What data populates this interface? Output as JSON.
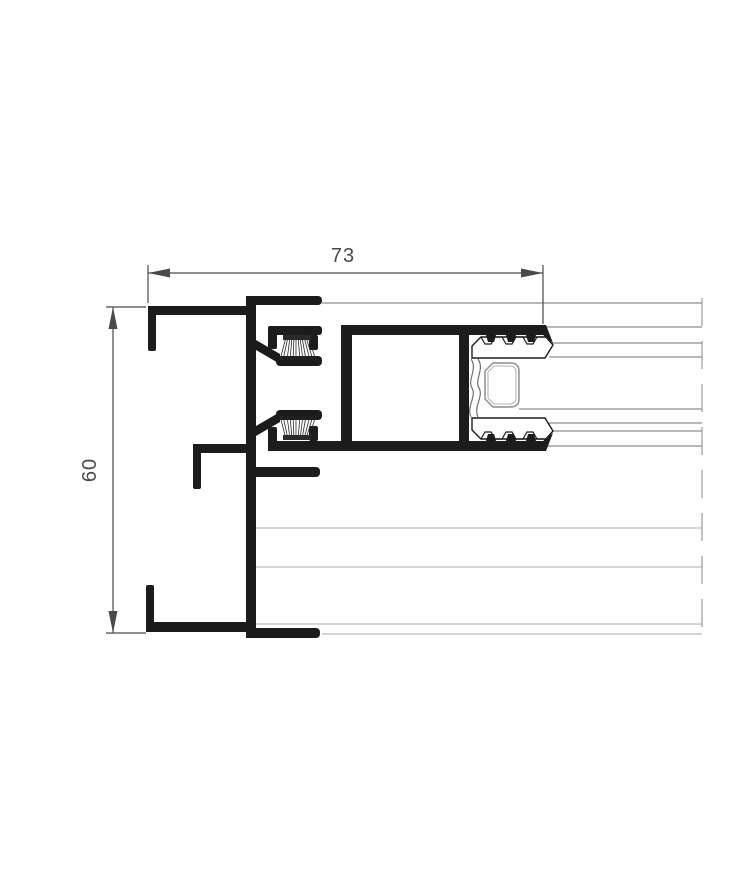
{
  "drawing": {
    "width_dimension_label": "73",
    "height_dimension_label": "60"
  },
  "colors": {
    "profile": "#1c1c1c",
    "bristle": "#2a2a2a",
    "dimension": "#4a4a4a",
    "glass_line": "#6f6f6f",
    "panel_line": "#bcbcbc",
    "break_line": "#9a9a9a",
    "gasket_fill": "#ffffff",
    "spacer_outline": "#9c9c9c",
    "spacer_inner": "#b3b3b3",
    "background": "#ffffff"
  }
}
